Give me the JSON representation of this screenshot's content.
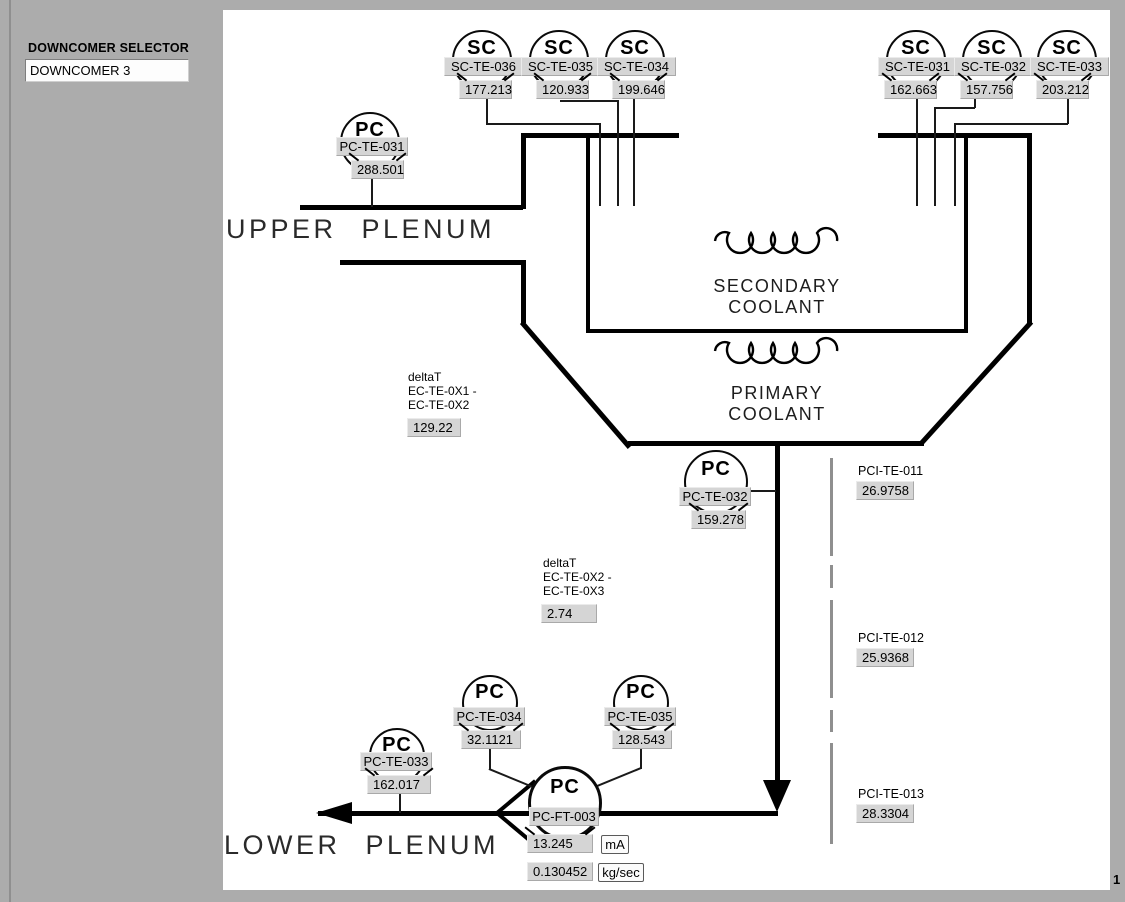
{
  "page": {
    "number": "1"
  },
  "selector": {
    "label": "DOWNCOMER SELECTOR",
    "value": "DOWNCOMER 3"
  },
  "labels": {
    "upper_plenum": "UPPER  PLENUM",
    "lower_plenum": "LOWER  PLENUM",
    "secondary_coolant_line1": "SECONDARY",
    "secondary_coolant_line2": "COOLANT",
    "primary_coolant_line1": "PRIMARY",
    "primary_coolant_line2": "COOLANT"
  },
  "sensors": {
    "sc_te_036": {
      "symbol": "SC",
      "tag": "SC-TE-036",
      "value": "177.213"
    },
    "sc_te_035": {
      "symbol": "SC",
      "tag": "SC-TE-035",
      "value": "120.933"
    },
    "sc_te_034": {
      "symbol": "SC",
      "tag": "SC-TE-034",
      "value": "199.646"
    },
    "sc_te_031": {
      "symbol": "SC",
      "tag": "SC-TE-031",
      "value": "162.663"
    },
    "sc_te_032": {
      "symbol": "SC",
      "tag": "SC-TE-032",
      "value": "157.756"
    },
    "sc_te_033": {
      "symbol": "SC",
      "tag": "SC-TE-033",
      "value": "203.212"
    },
    "pc_te_031": {
      "symbol": "PC",
      "tag": "PC-TE-031",
      "value": "288.501"
    },
    "pc_te_032": {
      "symbol": "PC",
      "tag": "PC-TE-032",
      "value": "159.278"
    },
    "pc_te_033": {
      "symbol": "PC",
      "tag": "PC-TE-033",
      "value": "162.017"
    },
    "pc_te_034": {
      "symbol": "PC",
      "tag": "PC-TE-034",
      "value": "32.1121"
    },
    "pc_te_035": {
      "symbol": "PC",
      "tag": "PC-TE-035",
      "value": "128.543"
    },
    "pc_ft_003": {
      "symbol": "PC",
      "tag": "PC-FT-003",
      "current": "13.245",
      "current_unit": "mA",
      "flow": "0.130452",
      "flow_unit": "kg/sec"
    }
  },
  "delta_t": [
    {
      "title": "deltaT",
      "line1": "EC-TE-0X1 -",
      "line2": "EC-TE-0X2",
      "value": "129.22"
    },
    {
      "title": "deltaT",
      "line1": "EC-TE-0X2 -",
      "line2": "EC-TE-0X3",
      "value": "2.74"
    }
  ],
  "pci_sensors": [
    {
      "tag": "PCI-TE-011",
      "value": "26.9758"
    },
    {
      "tag": "PCI-TE-012",
      "value": "25.9368"
    },
    {
      "tag": "PCI-TE-013",
      "value": "28.3304"
    }
  ],
  "colors": {
    "background": "#acacac",
    "canvas": "#ffffff",
    "callout_box": "#d5d5d5",
    "line": "#000000",
    "divider": "#8f8f8f"
  }
}
